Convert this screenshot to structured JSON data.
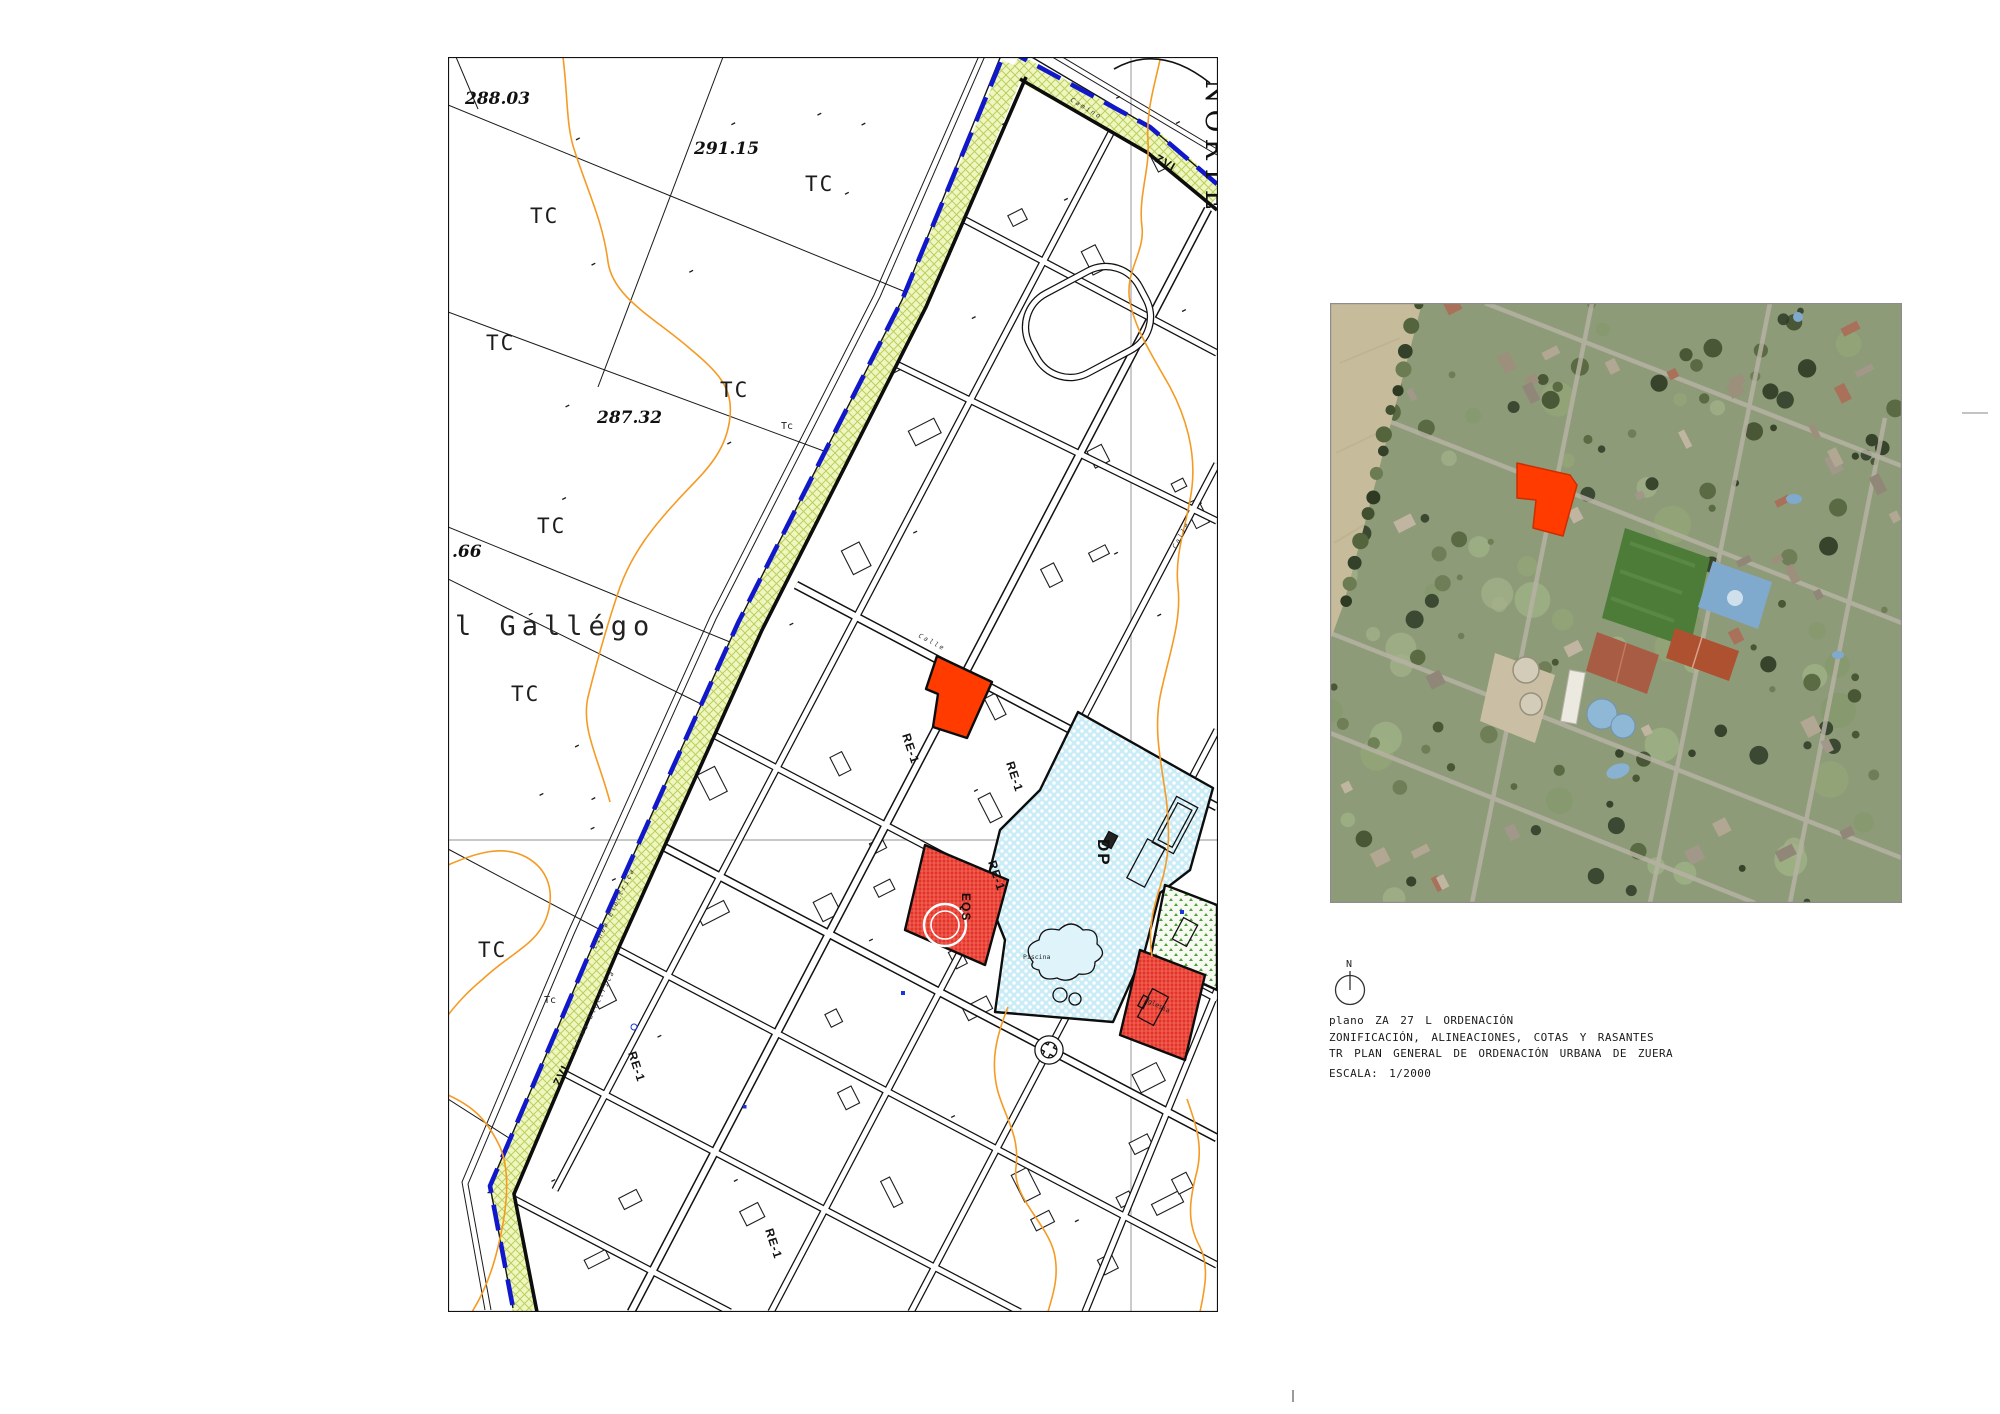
{
  "map": {
    "elev1": "288.03",
    "elev2": "291.15",
    "elev3": "287.32",
    "elev4": ".66",
    "tc": "TC",
    "tc_small": "Tc",
    "river": "l Gallégo",
    "norte": "NORTE",
    "zvi": "ZVI",
    "dp": "DP",
    "eqs": "EQS",
    "re1": "RE-1",
    "camino": "Camino",
    "calle": "Calle",
    "linea_electrica": "Línea Eléctrica",
    "piscina": "Piscina",
    "iglesia": "Iglesia",
    "colors": {
      "subject_parcel": "#ff3b00",
      "dp_zone": "#c9ecf7",
      "equipment_zone": "#e63327",
      "green_zone": "#4e9e3d",
      "boundary_band": "#f0f6c0",
      "boundary_dash": "#1118cc",
      "contour": "#f59a23"
    }
  },
  "legend": {
    "north": "N",
    "line1": "plano ZA 27 L ORDENACIÓN",
    "line2": "ZONIFICACIÓN, ALINEACIONES, COTAS Y RASANTES",
    "line3": "TR PLAN GENERAL DE ORDENACIÓN URBANA DE ZUERA",
    "line4": "ESCALA: 1/2000"
  }
}
